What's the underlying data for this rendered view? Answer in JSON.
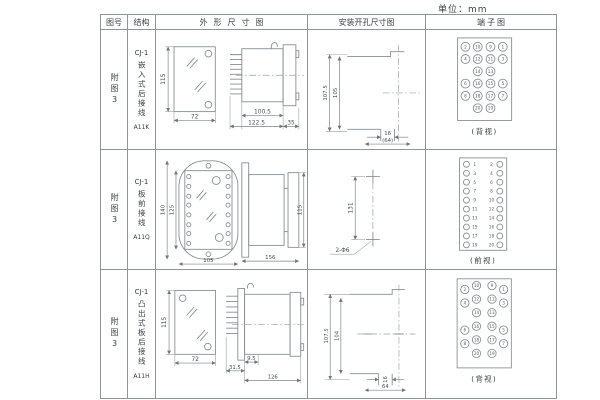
{
  "page": {
    "unit_label": "单位：mm"
  },
  "headers": {
    "fig_no": "图号",
    "structure": "结构",
    "outline": "外形尺寸图",
    "mounting": "安装开孔尺寸图",
    "terminal": "端子图"
  },
  "rows": [
    {
      "fig_no": "附图3",
      "model": "CJ-1",
      "structure_vertical": "嵌入式后接线",
      "code": "A11K",
      "outline": {
        "front_h": "115",
        "front_w": "72",
        "body_len": "100.5",
        "total_len": "122.5",
        "flange_d": "35"
      },
      "mounting": {
        "outer_h": "107.5",
        "inner_h": "105",
        "slot_w": "16",
        "total_w": "(64)"
      },
      "terminal": {
        "caption": "(背视)",
        "numbers": [
          "2",
          "10",
          "9",
          "1",
          "4",
          "12",
          "11",
          "3",
          "14",
          "13",
          "6",
          "16",
          "15",
          "5",
          "8",
          "18",
          "17",
          "7",
          "20",
          "19"
        ]
      }
    },
    {
      "fig_no": "附图3",
      "model": "CJ-1",
      "structure_vertical": "板前接线",
      "code": "A11Q",
      "outline": {
        "outer_h": "140",
        "inner_h": "125",
        "front_w": "105",
        "total_len": "156",
        "rear_h": "115"
      },
      "mounting": {
        "hole_span": "131",
        "hole_label": "2-Φ6"
      },
      "terminal": {
        "caption": "(前视)",
        "left_numbers": [
          "1",
          "3",
          "5",
          "7",
          "9",
          "11",
          "13",
          "15",
          "17",
          "19"
        ],
        "right_numbers": [
          "2",
          "4",
          "6",
          "8",
          "10",
          "12",
          "14",
          "16",
          "18",
          "20"
        ]
      }
    },
    {
      "fig_no": "附图3",
      "model": "CJ-1",
      "structure_vertical": "凸出式板后接线",
      "code": "A11H",
      "outline": {
        "front_h": "115",
        "front_w": "72",
        "front_d": "9.5",
        "pin_len": "31.5",
        "body_len": "126"
      },
      "mounting": {
        "outer_h": "107.5",
        "inner_h": "104",
        "slot_w": "16",
        "total_w": "64"
      },
      "terminal": {
        "caption": "(背视)",
        "numbers": [
          "2",
          "10",
          "9",
          "1",
          "4",
          "12",
          "11",
          "3",
          "14",
          "13",
          "6",
          "16",
          "15",
          "5",
          "8",
          "18",
          "17",
          "7",
          "20",
          "19"
        ]
      }
    }
  ]
}
